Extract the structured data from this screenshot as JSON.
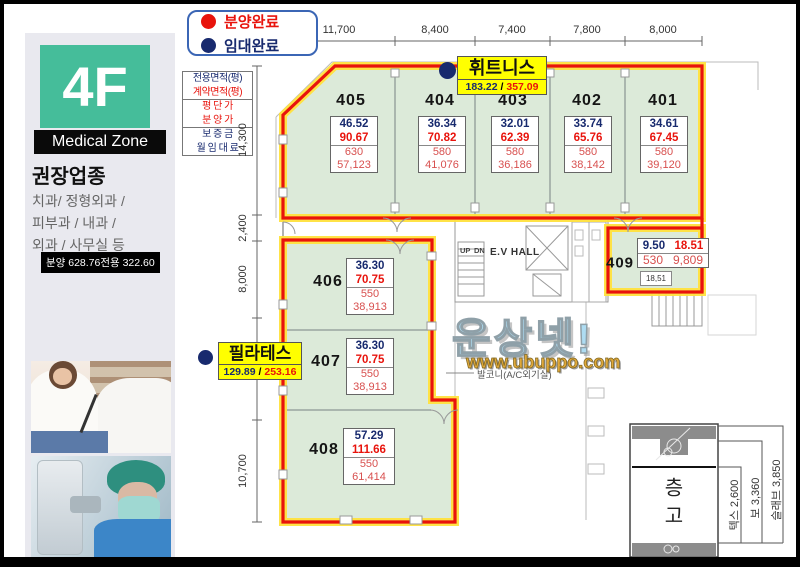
{
  "colors": {
    "red": "#e8130c",
    "red2": "#d8504f",
    "navy": "#182a6e",
    "teal": "#45bd9a",
    "yellow": "#ffff00",
    "green": "#dcead9",
    "halo": "#ffe23d"
  },
  "sidebar": {
    "floor": "4F",
    "zone": "Medical Zone",
    "heading": "권장업종",
    "lines": [
      "치과/ 정형외과 /",
      "피부과 / 내과 /",
      "외과 / 사무실  등"
    ],
    "badge": "분양 628.76전용 322.60"
  },
  "legend": {
    "items": [
      {
        "label": "분양완료"
      },
      {
        "label": "임대완료"
      }
    ]
  },
  "key_table": {
    "rows": [
      "전용면적(평)",
      "계약면적(평)",
      "평 단 가",
      "분 양 가",
      "보 증 금",
      "월 임 대 료"
    ]
  },
  "dims": {
    "top": [
      "11,700",
      "8,400",
      "7,400",
      "7,800",
      "8,000"
    ],
    "left": [
      "14,300",
      "2,400",
      "8,000",
      "10,700"
    ]
  },
  "units": [
    {
      "id": "405",
      "exclusive": "46.52",
      "contract": "90.67",
      "unit_price": "630",
      "total": "57,123"
    },
    {
      "id": "404",
      "exclusive": "36.34",
      "contract": "70.82",
      "unit_price": "580",
      "total": "41,076"
    },
    {
      "id": "403",
      "exclusive": "32.01",
      "contract": "62.39",
      "unit_price": "580",
      "total": "36,186"
    },
    {
      "id": "402",
      "exclusive": "33.74",
      "contract": "65.76",
      "unit_price": "580",
      "total": "38,142"
    },
    {
      "id": "401",
      "exclusive": "34.61",
      "contract": "67.45",
      "unit_price": "580",
      "total": "39,120"
    },
    {
      "id": "406",
      "exclusive": "36.30",
      "contract": "70.75",
      "unit_price": "550",
      "total": "38,913"
    },
    {
      "id": "407",
      "exclusive": "36.30",
      "contract": "70.75",
      "unit_price": "550",
      "total": "38,913"
    },
    {
      "id": "408",
      "exclusive": "57.29",
      "contract": "111.66",
      "unit_price": "550",
      "total": "61,414"
    },
    {
      "id": "409",
      "exclusive": "9.50",
      "contract": "18.51",
      "unit_price": "530",
      "total": "9,809",
      "note": "18,51"
    }
  ],
  "tags": [
    {
      "name": "휘트니스",
      "exclusive": "183.22",
      "sep": "/",
      "contract": "357.09"
    },
    {
      "name": "필라테스",
      "exclusive": "129.89",
      "sep": "/",
      "contract": "253.16"
    }
  ],
  "hall": {
    "ev": "E.V HALL",
    "up": "UP",
    "dn": "DN"
  },
  "watermark": {
    "title": "운상넷!",
    "url": "www.ubuppo.com",
    "balcony": "발코니(A/C외기실)"
  },
  "height_section": {
    "title": "층고",
    "labels": [
      "텍스 2,600",
      "보 3,360",
      "슬래브 3,850"
    ]
  }
}
